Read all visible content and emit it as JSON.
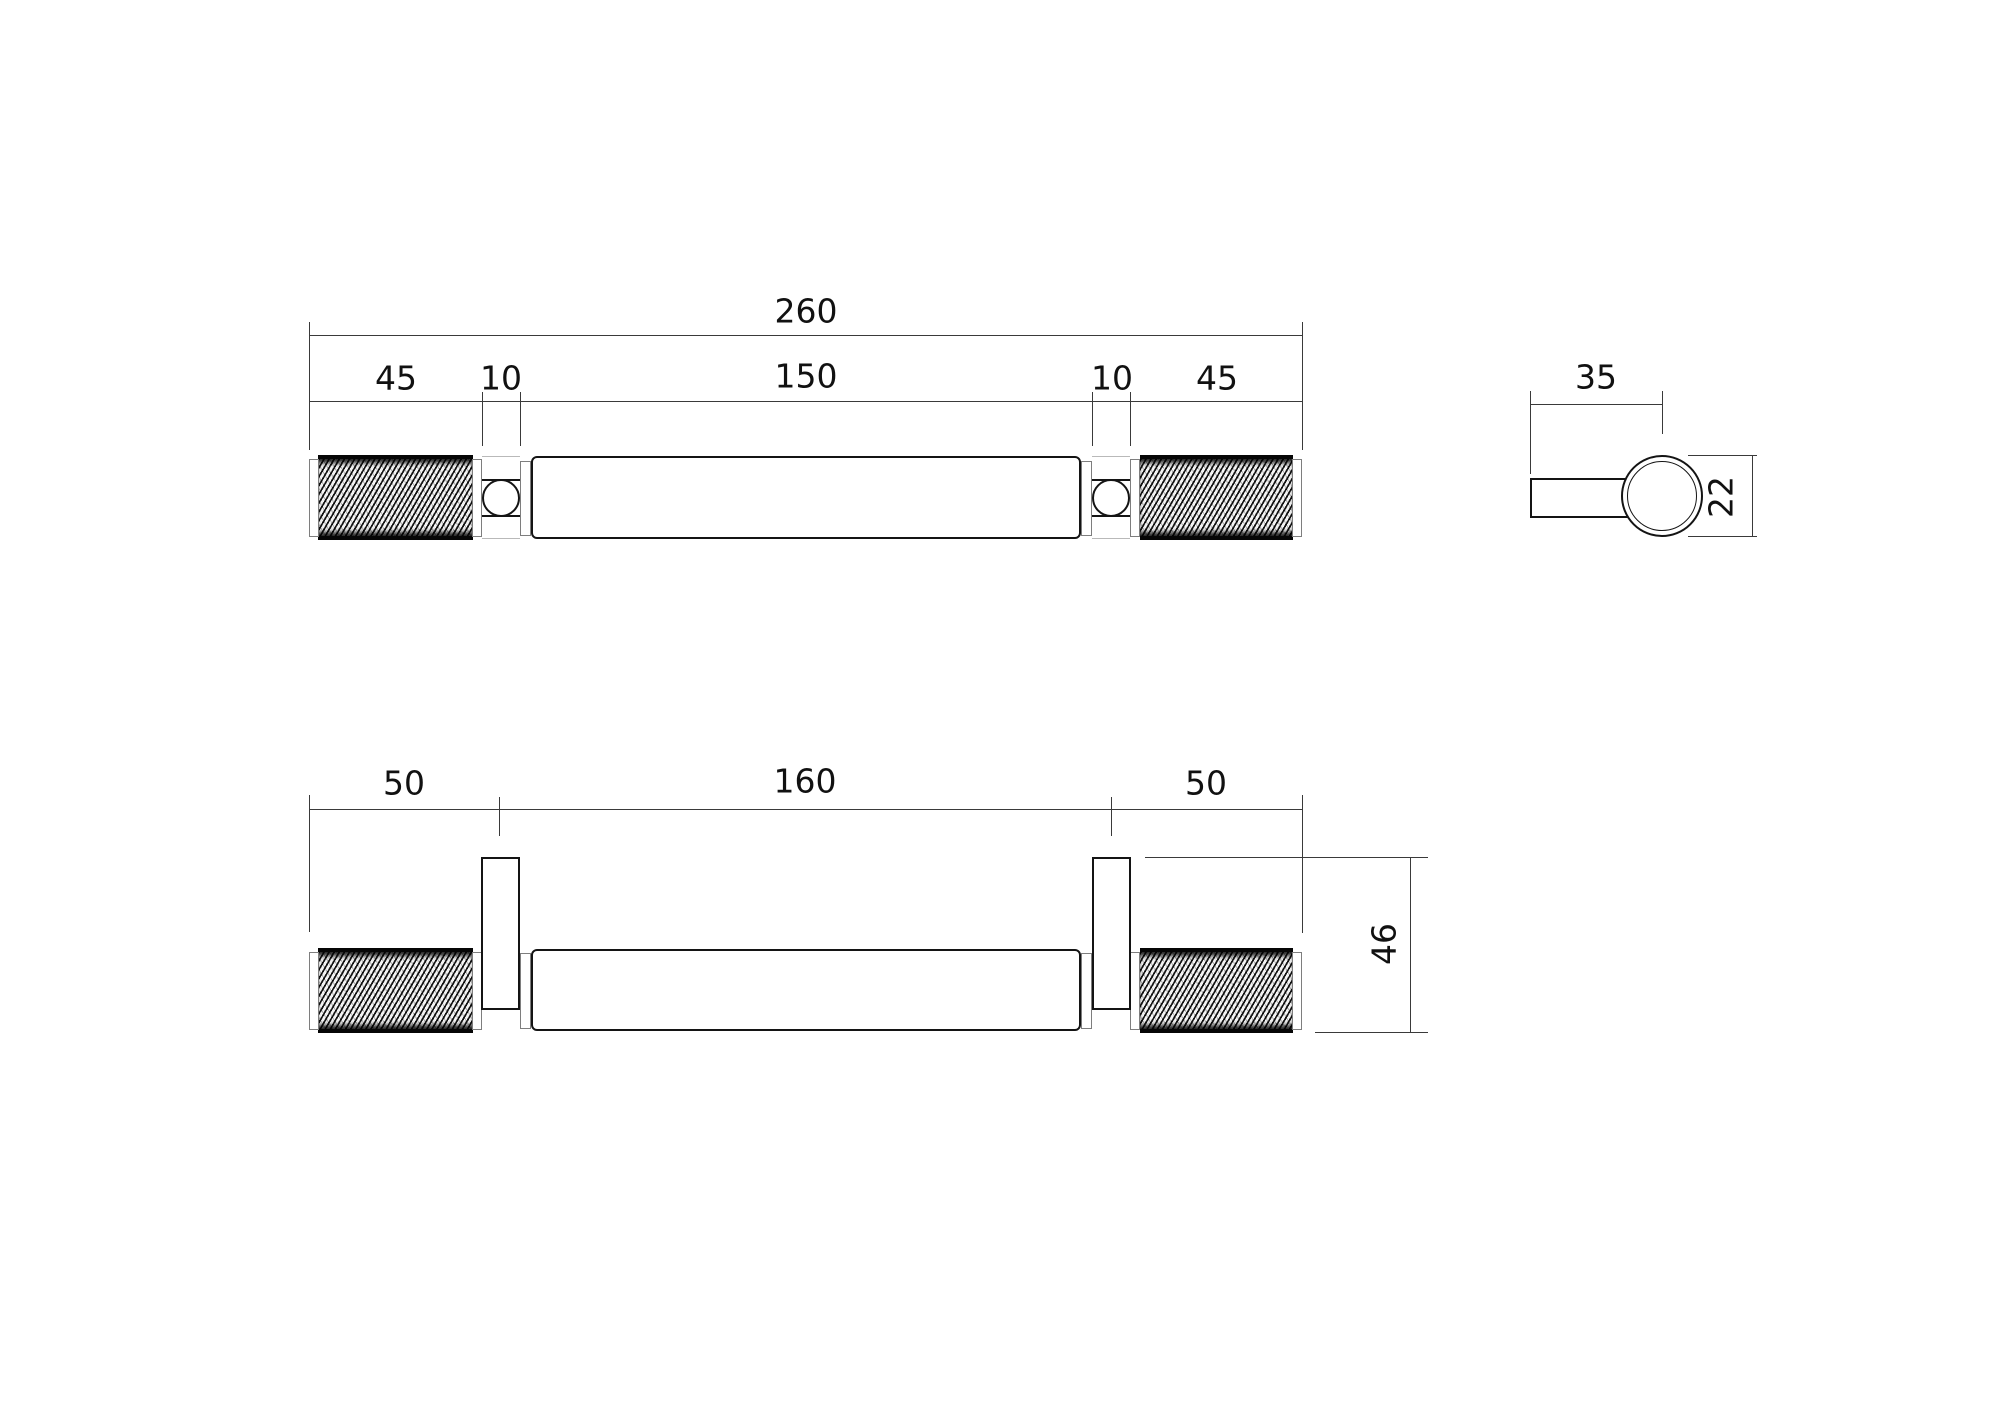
{
  "document": {
    "type": "technical-drawing",
    "subject": "knurled-bar-pull-handle",
    "units_shown": "mm"
  },
  "colors": {
    "background": "#ffffff",
    "part_outline": "#141414",
    "dimension_lines": "#3a3a3a",
    "text": "#111111",
    "cap_edges": "#7e7e7e"
  },
  "views": {
    "plan": {
      "overall": "260",
      "segments": [
        "45",
        "10",
        "150",
        "10",
        "45"
      ]
    },
    "end": {
      "stem_projection": "35",
      "diameter": "22"
    },
    "front": {
      "segments": [
        "50",
        "160",
        "50"
      ],
      "height": "46"
    }
  }
}
